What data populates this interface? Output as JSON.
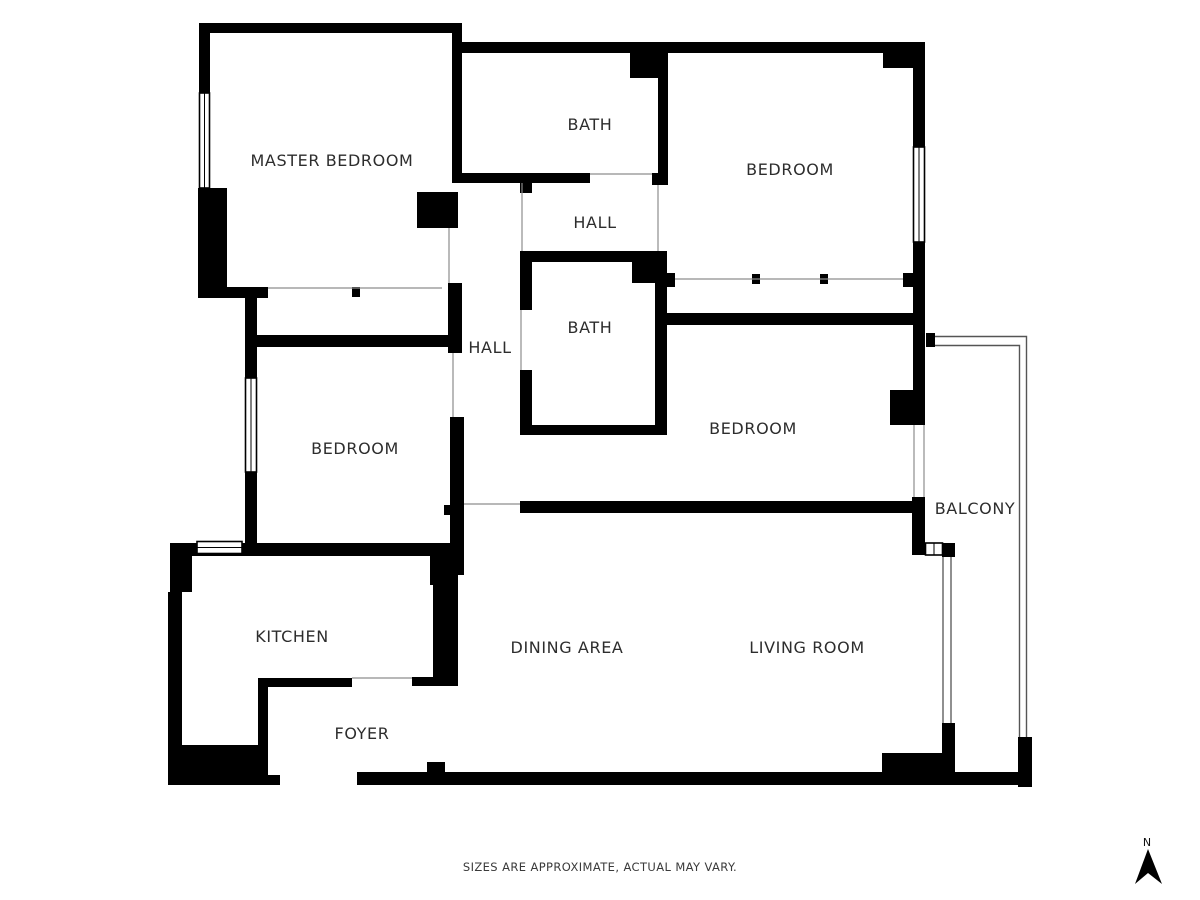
{
  "rooms": [
    {
      "id": "master-bedroom",
      "label": "MASTER BEDROOM"
    },
    {
      "id": "bath-top",
      "label": "BATH"
    },
    {
      "id": "hall-top",
      "label": "HALL"
    },
    {
      "id": "bedroom-top-right",
      "label": "BEDROOM"
    },
    {
      "id": "hall-center",
      "label": "HALL"
    },
    {
      "id": "bath-center",
      "label": "BATH"
    },
    {
      "id": "bedroom-left",
      "label": "BEDROOM"
    },
    {
      "id": "bedroom-right",
      "label": "BEDROOM"
    },
    {
      "id": "balcony",
      "label": "BALCONY"
    },
    {
      "id": "kitchen",
      "label": "KITCHEN"
    },
    {
      "id": "dining-area",
      "label": "DINING AREA"
    },
    {
      "id": "living-room",
      "label": "LIVING ROOM"
    },
    {
      "id": "foyer",
      "label": "FOYER"
    }
  ],
  "footer": {
    "disclaimer": "SIZES ARE APPROXIMATE, ACTUAL MAY VARY."
  },
  "compass": {
    "label": "N"
  },
  "colors": {
    "wall": "#000000",
    "label_text": "#2d2d2d",
    "thin_line": "#8d8d8d",
    "background": "#ffffff"
  }
}
